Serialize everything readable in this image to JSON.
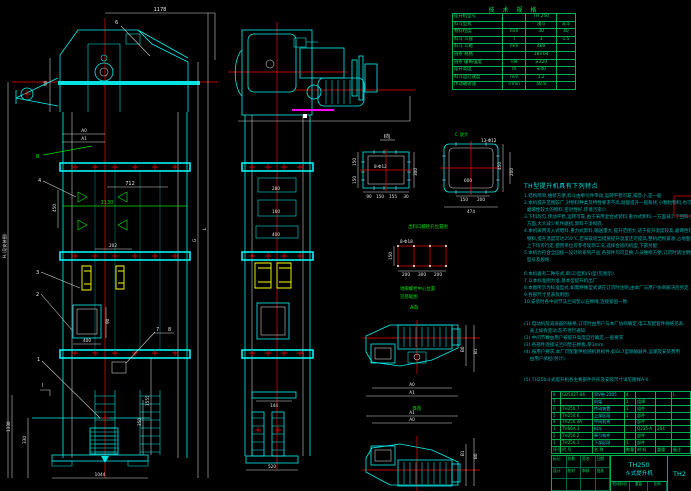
{
  "spec_table": {
    "title": "技 术 规 格",
    "rows": [
      {
        "label": "提升机型号",
        "unit": "",
        "v1": "TH 250",
        "v2": ""
      },
      {
        "label": "料斗型式",
        "unit": "",
        "v1": "浅斗",
        "v2": "深斗"
      },
      {
        "label": "物料粒度",
        "unit": "mm",
        "v1": "30",
        "v2": "40"
      },
      {
        "label": "料斗 斗容",
        "unit": "l",
        "v1": "3",
        "v2": "1.5"
      },
      {
        "label": "料斗 斗距",
        "unit": "mm",
        "v1": "480",
        "v2": ""
      },
      {
        "label": "链条 规格",
        "unit": "",
        "v1": "18×64",
        "v2": ""
      },
      {
        "label": "链条 破断强度",
        "unit": "kN",
        "v1": "≥320",
        "v2": ""
      },
      {
        "label": "提升高度",
        "unit": "m",
        "v1": "≤40",
        "v2": ""
      },
      {
        "label": "料斗运行速度",
        "unit": "m/s",
        "v1": "1.2",
        "v2": ""
      },
      {
        "label": "传动轴转速",
        "unit": "r/min",
        "v1": "48.8",
        "v2": ""
      }
    ]
  },
  "features": {
    "heading": "TH型提升机具有下列特点",
    "lines": [
      "1.结构简单,维修方便,料斗由牵引件带动,运转平稳可靠,噪音小,是一般",
      "2.本机提升范围较广,对物料种类及特性要求不高,既能提升一般粉状,小颗粒物料,也可提升",
      "  磨琢性较大的物料,密封性好,环境污染少.",
      "3.下料均匀,传动平稳,运转可靠,由于采用混合式装料,重力式卸料,一方面减少了回料,另一",
      "  方面,大大减少机件磨损,卸料干净彻底.",
      "4.本机采用流入式喂料,重力式卸料,输送量大,提升范围大,适于提升温度较高,磨琢性较大的",
      "  物料,提升温度可达250℃,若采取适当措施提升温度还可提高,整机结构紧凑,占地面积小,",
      "  上下均可行走,使用单位可参考现场工况,选择合适的机型,下部另配.",
      "5.本机为符合全国统一设计的系列产品,各部件均可互换,人员维修方便,订货时请注明所需",
      "  型号及规格.",
      "",
      "6.本机备有二种形式,即(Z)型和(S)型(见图示).",
      "7.以本标准图为准,基本型提升机出厂.",
      "8.本图所示为标准型式,如需特殊型式请在订货时注明,由本厂与用户协商解决后另定.",
      "9.各部尺寸见表及附图.",
      "10.安装时各中间节法兰间垫以石棉绳,连接紧固一致.",
      "",
      "",
      "(1).电动机及减速器的规格,订货时由用户与本厂协商确定,电工及配套件规格见表,",
      "    表上如有变动,恕不另行通知.",
      "(2).中间节数由用户按提升高度自行确定,一般要求.",
      "(3).各部件连接法兰间垫石棉板,厚3mm.",
      "(4).按用户要求,本厂可配套供给随机易损件,如GL7型联轴器件,运输及安装费用",
      "    由用户承担(另计).",
      "",
      "",
      "(5).TH250斗式提升机各主要部件外形及安装尺寸详见图样A-0."
    ]
  },
  "parts_table": {
    "headers": [
      "序号",
      "代 号",
      "名 称",
      "数量",
      "材 料",
      "重量",
      "备注"
    ],
    "rows": [
      [
        "8",
        "GB5027-86",
        "窄V带 2305",
        "4",
        "",
        "",
        "L"
      ],
      [
        "7",
        "",
        "机架",
        "1",
        "组焊",
        "",
        ""
      ],
      [
        "6",
        "TH250.7",
        "传动装置",
        "1",
        "组件",
        "",
        ""
      ],
      [
        "5",
        "TH250.6",
        "上部区段",
        "1",
        "部件",
        "",
        ""
      ],
      [
        "4",
        "TH250.4A",
        "中间机壳",
        "",
        "部件",
        "",
        ""
      ],
      [
        "3",
        "TH66A.3",
        "料斗",
        "",
        "Q235-A",
        "204",
        ""
      ],
      [
        "2",
        "TH250.2",
        "牵引构件",
        "",
        "部件",
        "",
        ""
      ],
      [
        "1",
        "TH250.1",
        "下部区段",
        "1",
        "部件",
        "",
        ""
      ]
    ]
  },
  "title_block": {
    "model": "TH250",
    "product": "斗式提升机",
    "drawing_no": "TH2",
    "row1": [
      "标记",
      "处数",
      "签名",
      "日期"
    ],
    "row2": [
      "设计",
      "校对",
      "审核",
      "批准"
    ],
    "strip": [
      "阶段标记",
      "重量",
      "比例"
    ]
  },
  "callouts": {
    "n1": "1",
    "n2": "2",
    "n3": "3",
    "n4": "4",
    "n6": "6",
    "n7": "7",
    "n8": "8",
    "b": "B",
    "sec_i": "Ⅰ"
  },
  "dims": {
    "top": "1178",
    "a0": "A0",
    "a1": "A1",
    "left90": "90",
    "d712": "712",
    "d450": "450",
    "d1130": "1130",
    "d202": "202",
    "d400": "400",
    "d90b": "90",
    "d1555": "1555",
    "d350": "350",
    "d1330": "1330",
    "d330": "330",
    "d1044": "1044",
    "H": "H,(见安装图)",
    "L": "L",
    "G": "G",
    "s280": "280",
    "s160": "160",
    "s400": "400",
    "s144": "144",
    "s520": "520",
    "i_label": "Ⅰ向",
    "i_holes": "8-Φ12",
    "i_300": "300",
    "i_150a": "150",
    "i_150b": "150",
    "i_b90": "90",
    "i_b150": "150",
    "i_b155": "155",
    "i_b30": "30",
    "c_label": "C 放大",
    "c_holes": "13-Φ12",
    "c_600": "600",
    "c_150": "150",
    "c_200": "200",
    "c_474": "474",
    "c_450": "450",
    "c_r200": "200",
    "r_holes": "8-Φ18",
    "r_150": "150",
    "r_200a": "200",
    "r_300": "300",
    "r_200b": "200",
    "p1_a0": "A0",
    "p1_a1": "A1",
    "p1_b0": "B0",
    "p1_b1": "B1",
    "p2_a0": "A0",
    "p2_a1": "A1",
    "p2_b0": "B0",
    "p2_b1": "B1"
  },
  "labels": {
    "outlet_caption": "出料口螺栓孔位置图",
    "anchor_line1": "地脚螺栓中心位置",
    "anchor_line2": "见基础图",
    "view_a": "A向",
    "view_b": "B向"
  }
}
